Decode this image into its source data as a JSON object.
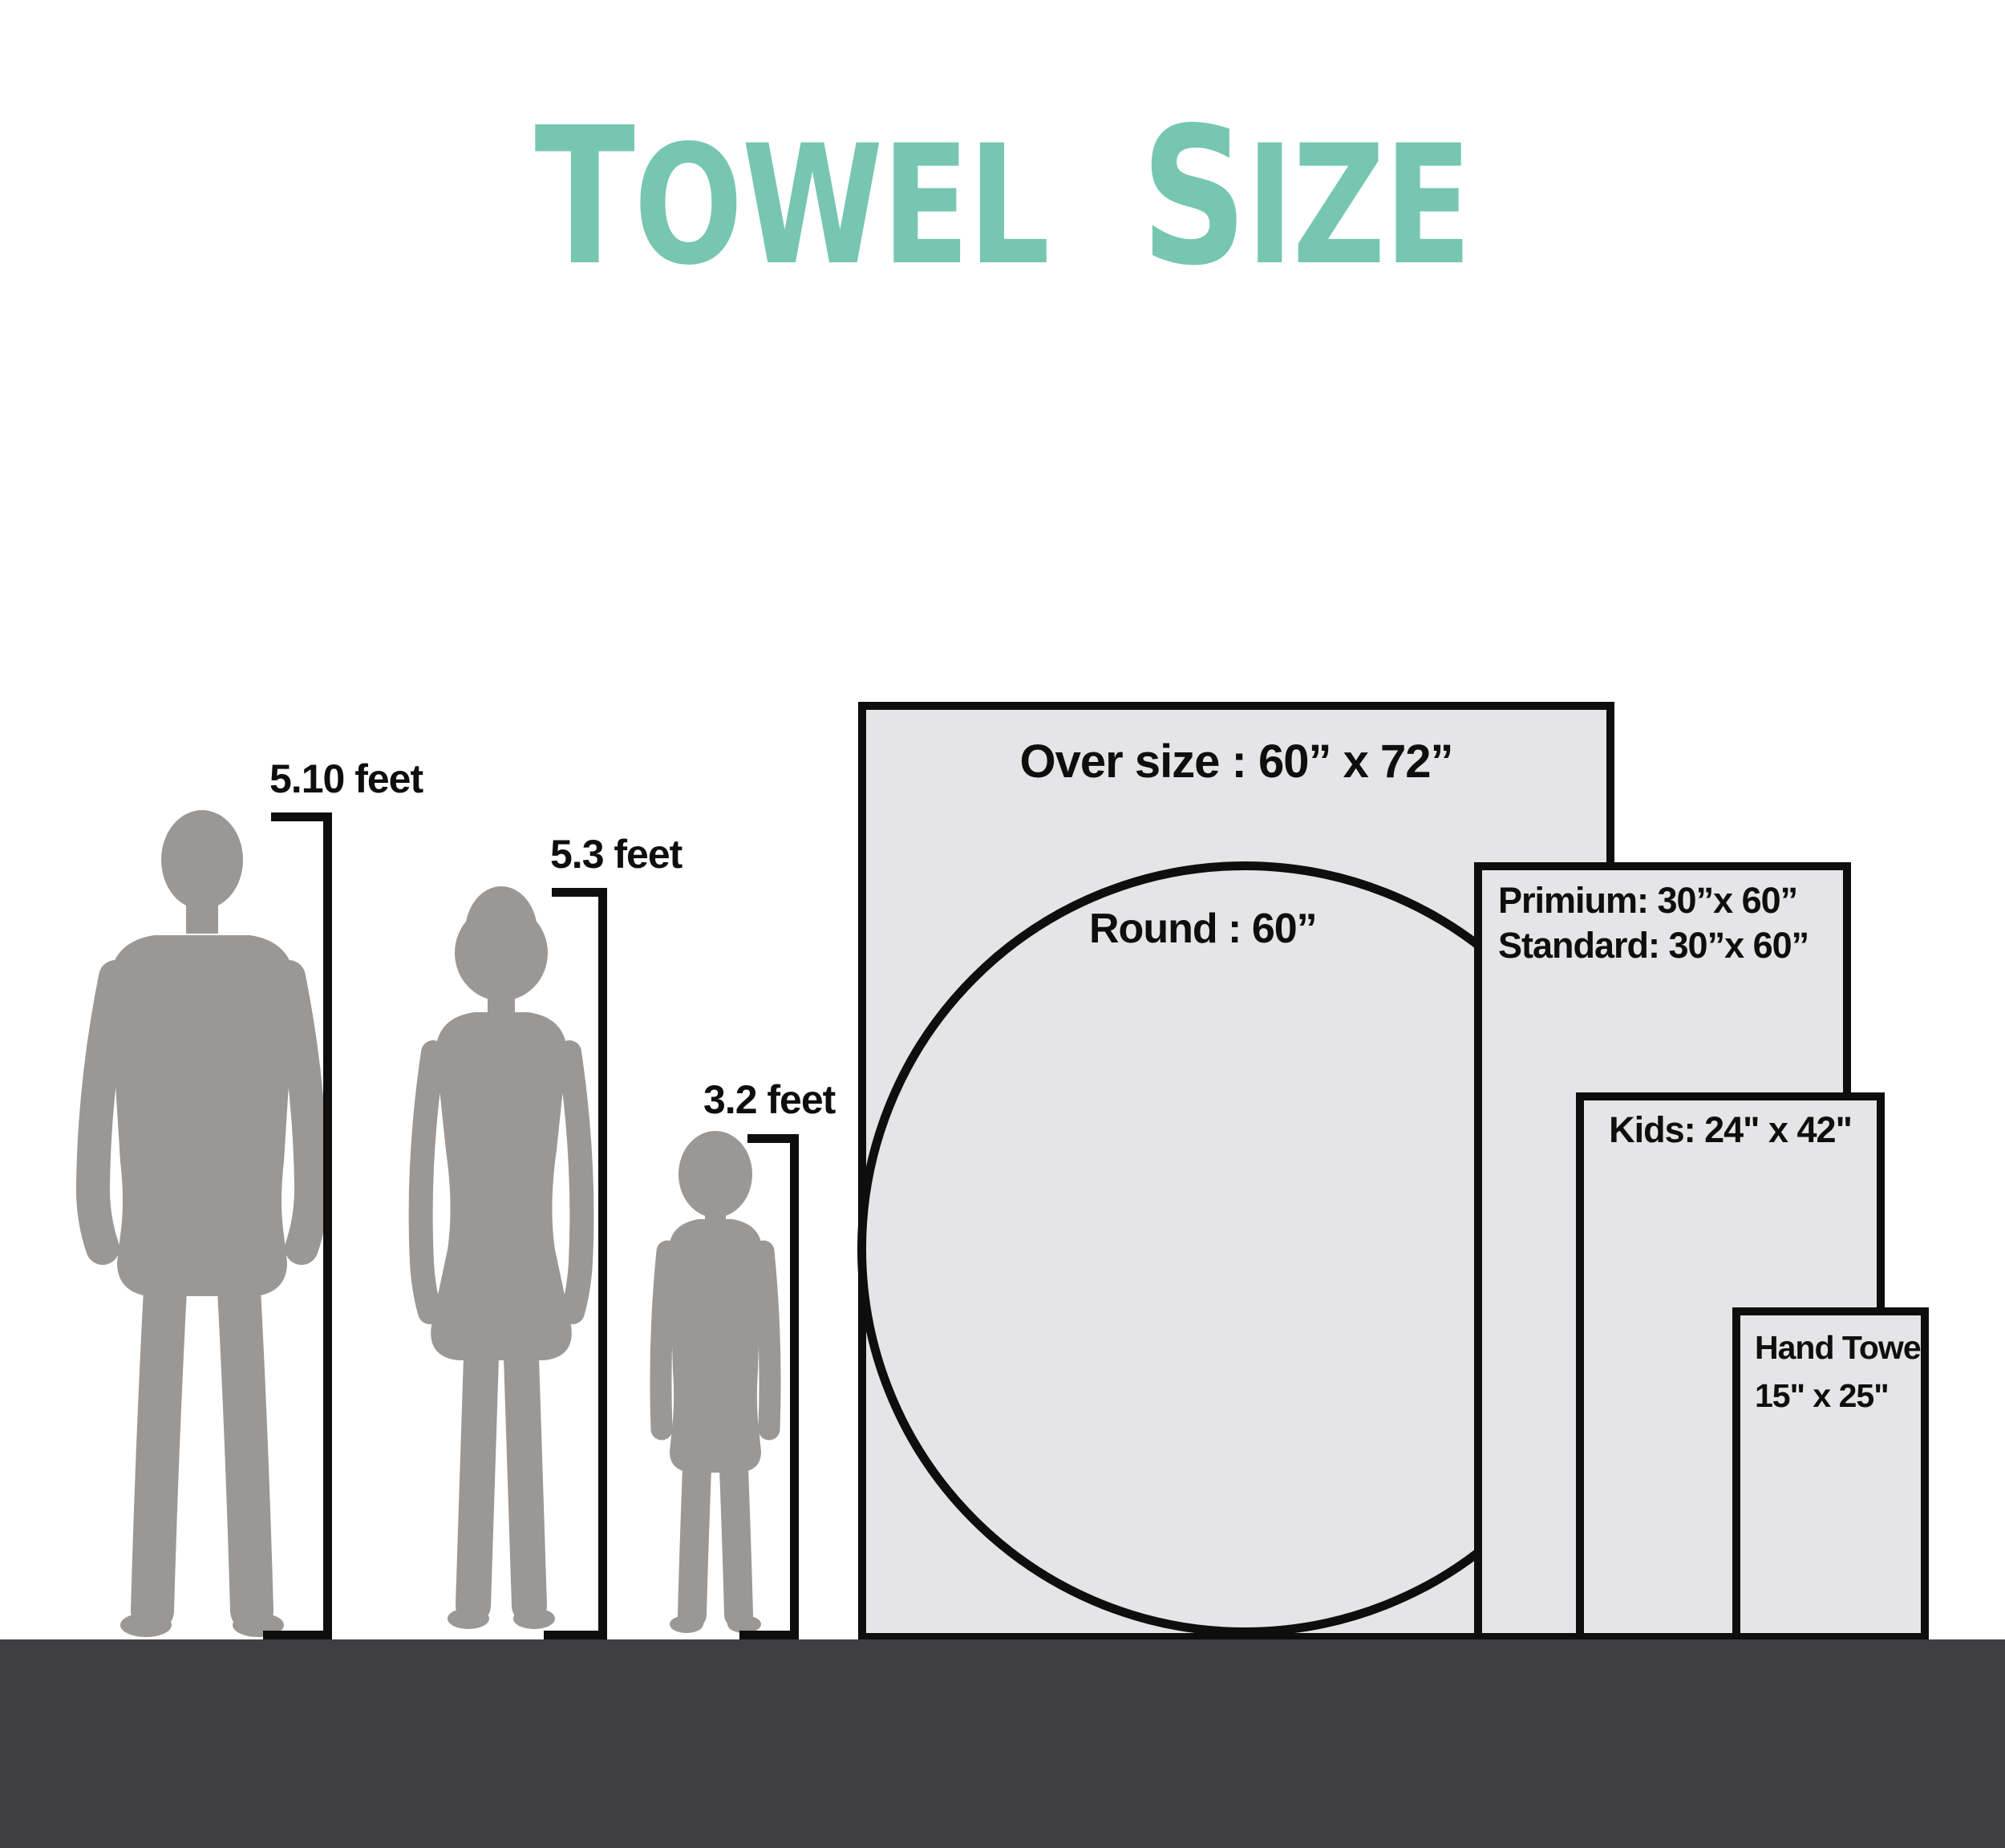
{
  "title": {
    "word1": "TOWEL",
    "word2": "SIZE"
  },
  "figures": [
    {
      "name": "man",
      "height_label": "5.10 feet"
    },
    {
      "name": "woman",
      "height_label": "5.3 feet"
    },
    {
      "name": "child",
      "height_label": "3.2 feet"
    }
  ],
  "towels": {
    "oversize_label": "Over size  : 60” x 72”",
    "round_label": "Round  : 60”",
    "premium_line1": "Primium:  30”x 60”",
    "premium_line2": "Standard:  30”x 60”",
    "kids_label": "Kids: 24\" x 42\"",
    "hand_line1": "Hand Towel",
    "hand_line2": "15\" x 25\""
  },
  "colors": {
    "accent_teal": "#76C6B2",
    "silhouette_gray": "#9B9794",
    "towel_fill": "#E5E4E6",
    "outline_black": "#0E0E0E",
    "floor_dark": "#3F3E40"
  }
}
